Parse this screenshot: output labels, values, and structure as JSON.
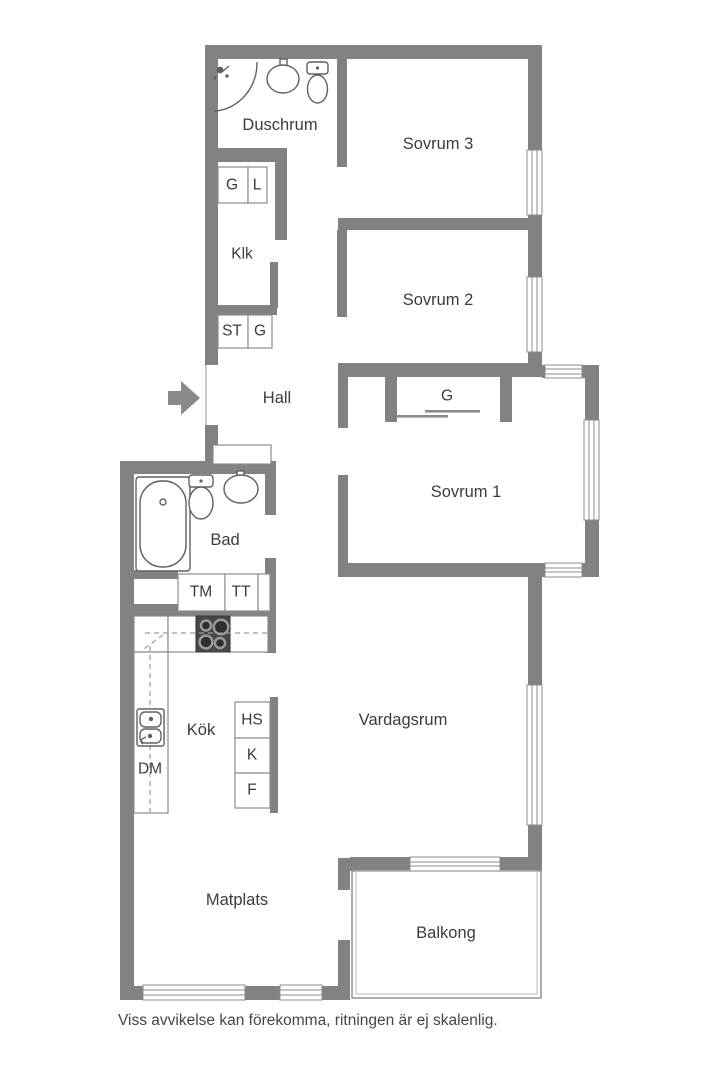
{
  "rooms": {
    "duschrum": "Duschrum",
    "sovrum3": "Sovrum 3",
    "klk": "Klk",
    "sovrum2": "Sovrum 2",
    "hall": "Hall",
    "sovrum1": "Sovrum 1",
    "bad": "Bad",
    "kok": "Kök",
    "vardagsrum": "Vardagsrum",
    "matplats": "Matplats",
    "balkong": "Balkong"
  },
  "storage": {
    "g_hall": "G",
    "l_hall": "L",
    "st_hall": "ST",
    "g_hall2": "G",
    "g_sovrum1": "G"
  },
  "appliances": {
    "tm": "TM",
    "tt": "TT",
    "dm": "DM",
    "hs": "HS",
    "k": "K",
    "f": "F"
  },
  "footer": {
    "disclaimer": "Viss avvikelse kan förekomma, ritningen är ej skalenlig."
  },
  "colors": {
    "wall": "#828282",
    "thin_line": "#8c8c8c",
    "fixture_stroke": "#606060",
    "stove_dark": "#474747",
    "text": "#3c3c3c"
  }
}
